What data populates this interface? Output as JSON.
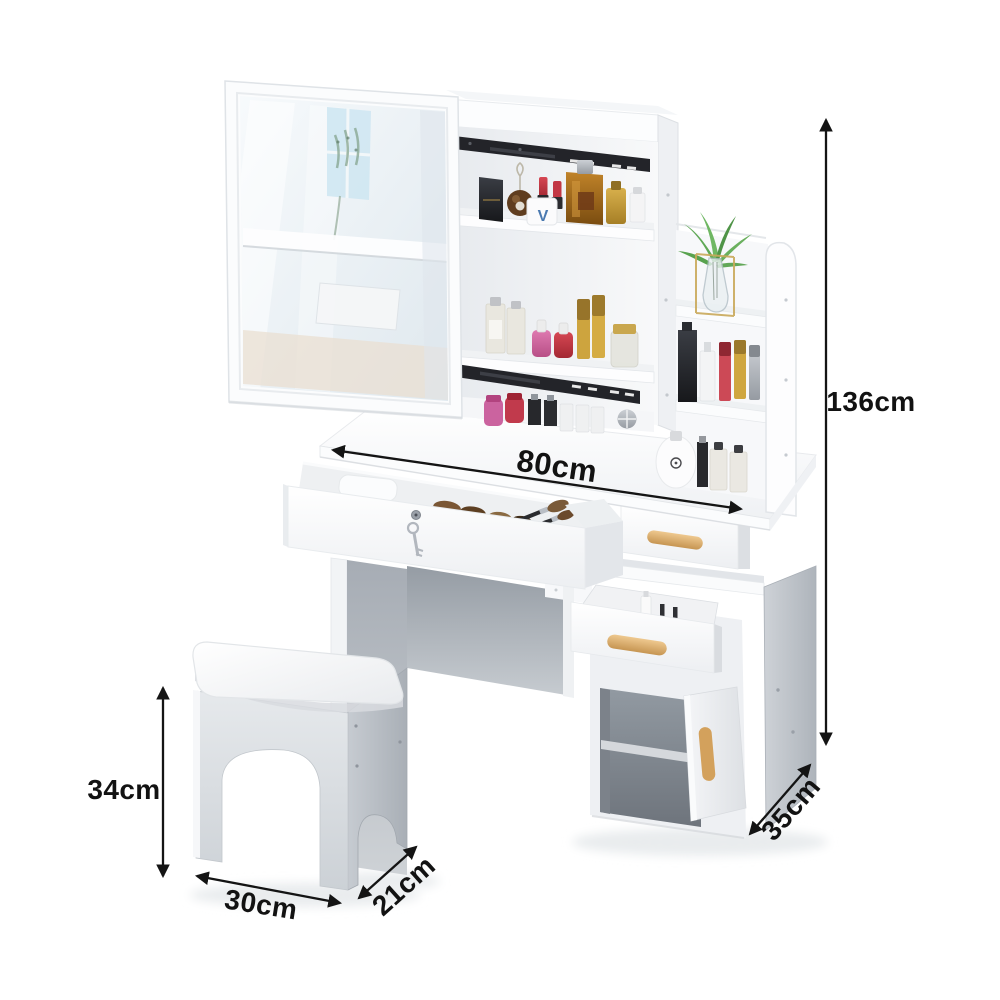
{
  "canvas": {
    "width": 1000,
    "height": 1000,
    "background": "#ffffff"
  },
  "illustration": {
    "jar_monogram": "V",
    "palette": {
      "furniture_white": "#fdfdfe",
      "panel_gray": "#c7cbd1",
      "under_table_shadow_gray": "#9aa1a9",
      "slide_rail_black": "#232429",
      "wood_handle": "#dcb074",
      "plant_green": "#63ab58",
      "amber_perfume": "#a9731f",
      "lipstick_red": "#c23744",
      "nail_pink": "#d06ca8",
      "gold": "#c9a23f",
      "mirror_tint": "#e8f0f5",
      "annotation_black": "#141414"
    }
  },
  "dimensions": {
    "height": {
      "label": "136cm"
    },
    "width": {
      "label": "80cm"
    },
    "stool_height": {
      "label": "34cm"
    },
    "stool_width": {
      "label": "30cm"
    },
    "stool_depth": {
      "label": "21cm"
    },
    "cabinet_depth": {
      "label": "35cm"
    }
  }
}
